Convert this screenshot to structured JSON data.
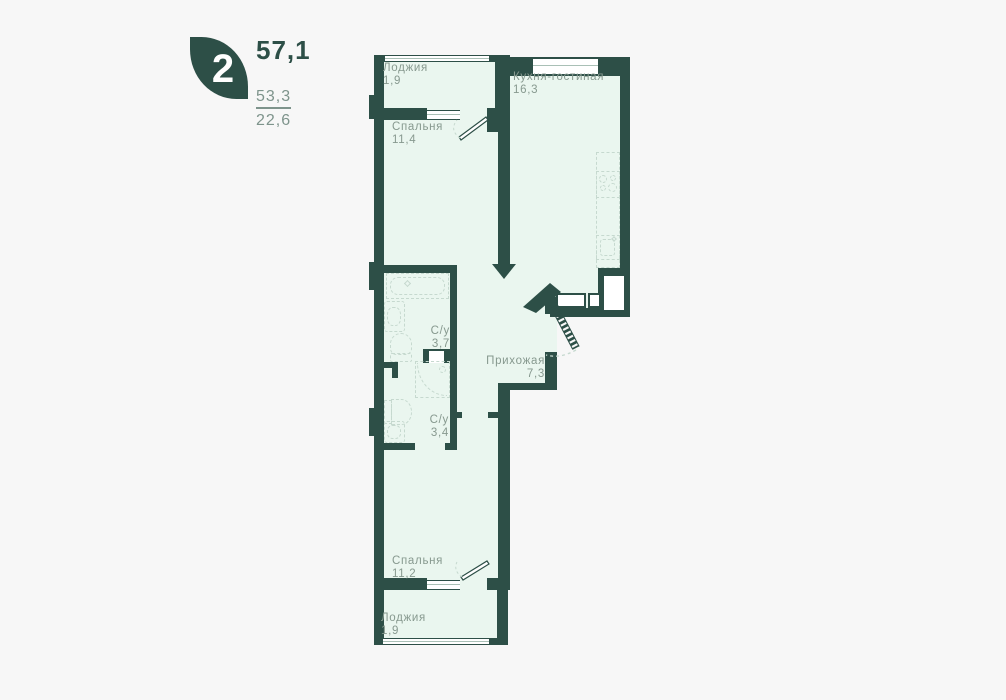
{
  "page": {
    "background": "#f7f7f7"
  },
  "colors": {
    "wall": "#2d4f47",
    "room_fill": "#eaf6ef",
    "fixture_line": "#c6d9cf",
    "label_text": "#87998f",
    "secondary_text": "#7e948c",
    "window_fill": "#ffffff"
  },
  "badge": {
    "room_count": "2",
    "total_area": "57,1",
    "living_area": "53,3",
    "kitchen_area": "22,6"
  },
  "rooms": [
    {
      "name": "Лоджия",
      "area": "1,9"
    },
    {
      "name": "Спальня",
      "area": "11,4"
    },
    {
      "name": "Кухня-гостиная",
      "area": "16,3"
    },
    {
      "name": "С/у",
      "area": "3,7"
    },
    {
      "name": "Прихожая",
      "area": "7,3"
    },
    {
      "name": "С/у",
      "area": "3,4"
    },
    {
      "name": "Спальня",
      "area": "11,2"
    },
    {
      "name": "Лоджия",
      "area": "1,9"
    }
  ],
  "icons": {
    "logo-leaf-icon": "css-leaf-shape",
    "bathtub-icon": "dashed-nested-rects",
    "washbasin-icon": "dashed-rounded-rect",
    "toilet-icon": "dashed-arch-with-tank",
    "shower-icon": "dashed-square-quarter-arc",
    "stove-icon": "four-dashed-circles",
    "kitchen-sink-icon": "dashed-rounded-rect",
    "vent-shaft-icon": "white-rect-in-wall",
    "cabinet-icon": "white-bordered-box",
    "door-swing-icon": "svg-dashed-arc",
    "entrance-door-icon": "svg-hatched-diagonal",
    "wall-end-arrow-icon": "svg-triangle"
  }
}
